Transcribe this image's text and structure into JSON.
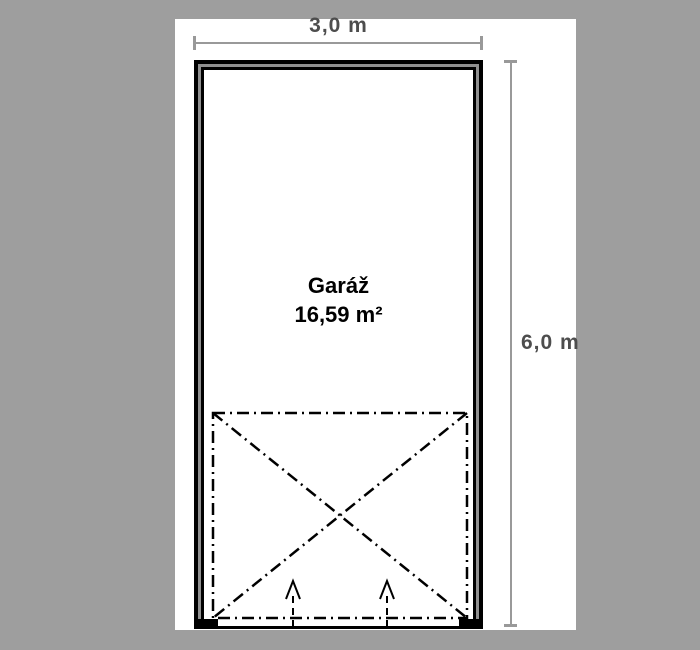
{
  "plan": {
    "room": {
      "name": "Garáž",
      "area": "16,59 m²"
    },
    "dimensions": {
      "width_label": "3,0 m",
      "height_label": "6,0 m"
    }
  },
  "colors": {
    "background": "#9e9e9e",
    "wall_fill": "#909090",
    "dimension_line": "#999999",
    "dimension_text": "#4d4d4d",
    "line": "#000000",
    "sheet": "#ffffff"
  }
}
